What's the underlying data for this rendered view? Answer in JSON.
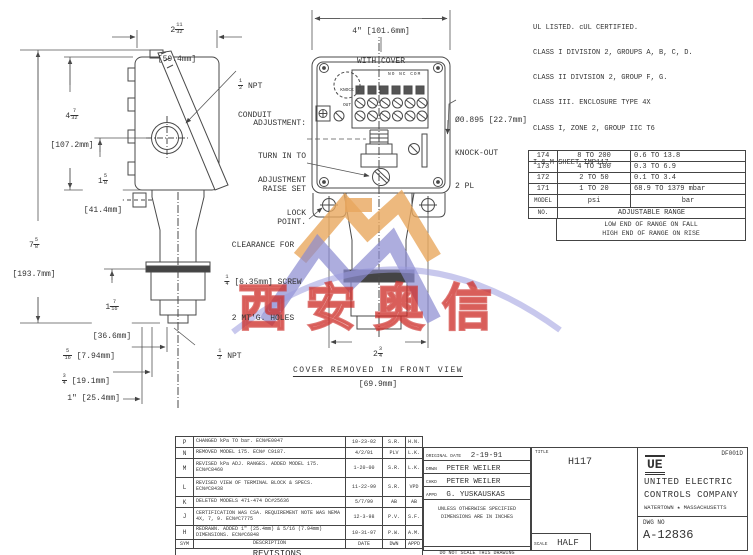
{
  "certifications": {
    "line1": "UL LISTED. cUL CERTIFIED.",
    "line2": "CLASS I DIVISION 2, GROUPS A, B, C, D.",
    "line3": "CLASS II DIVISION 2, GROUP F, G.",
    "line4": "CLASS III. ENCLOSURE TYPE 4X",
    "line5": "CLASS I, ZONE 2, GROUP IIC T6",
    "sheet": "I & M SHEET IMP117."
  },
  "range_table": {
    "rows": [
      {
        "model": "174",
        "psi": "8 TO 200",
        "bar": "0.6 TO 13.8"
      },
      {
        "model": "173",
        "psi": "4 TO 100",
        "bar": "0.3 TO 6.9"
      },
      {
        "model": "172",
        "psi": "2 TO 50",
        "bar": "0.1 TO 3.4"
      },
      {
        "model": "171",
        "psi": "1 TO 20",
        "bar": "68.9 TO 1379 mbar"
      }
    ],
    "model_label_1": "MODEL",
    "model_label_2": "NO.",
    "psi": "psi",
    "bar": "bar",
    "adjustable": "ADJUSTABLE RANGE",
    "note_fall": "LOW END OF RANGE ON FALL",
    "note_rise": "HIGH END OF RANGE ON RISE"
  },
  "dims": {
    "top_width": {
      "whole": "2",
      "num": "11",
      "den": "32",
      "metric": "[59.4mm]"
    },
    "body_height": {
      "whole": "4",
      "num": "7",
      "den": "32",
      "metric": "[107.2mm]"
    },
    "lower_height": {
      "whole": "1",
      "num": "5",
      "den": "8",
      "metric": "[41.4mm]"
    },
    "total_height": {
      "whole": "7",
      "num": "5",
      "den": "8",
      "metric": "[193.7mm]"
    },
    "port_height": {
      "whole": "1",
      "num": "7",
      "den": "16",
      "metric": "[36.6mm]"
    },
    "dim_516": {
      "num": "5",
      "den": "16",
      "metric": "[7.94mm]"
    },
    "dim_34": {
      "num": "3",
      "den": "4",
      "metric": "[19.1mm]"
    },
    "dim_1in": "1\" [25.4mm]",
    "cover_width_line1": "4\" [101.6mm]",
    "cover_width_line2": "WITH COVER",
    "front_width": {
      "whole": "2",
      "num": "3",
      "den": "4",
      "metric": "[69.9mm]"
    }
  },
  "callouts": {
    "npt_conduit": {
      "num": "1",
      "den": "2",
      "text1": "NPT",
      "text2": "CONDUIT"
    },
    "adj1": "ADJUSTMENT:",
    "adj2": "TURN IN TO",
    "adj3": "RAISE SET",
    "adj4": "POINT.",
    "lock1": "ADJUSTMENT",
    "lock2": "LOCK",
    "ko1": "Ø0.895 [22.7mm]",
    "ko2": "KNOCK-OUT",
    "ko3": "2 PL",
    "clr1": "CLEARANCE FOR",
    "clr_num": "1",
    "clr_den": "4",
    "clr2": "[6.35mm] SCREW",
    "clr3": "2 MT'G. HOLES",
    "npt_bottom": {
      "num": "1",
      "den": "2",
      "text": "NPT"
    },
    "cover_removed": "COVER REMOVED IN FRONT VIEW",
    "terminal_labels": "NO NC COM",
    "knock_circle_1": "KNOCK",
    "knock_circle_2": "OUT"
  },
  "revisions": {
    "title": "REVISIONS",
    "headers": {
      "sym": "SYM",
      "description": "DESCRIPTION",
      "date": "DATE",
      "dwn": "DWN",
      "appd": "APPD"
    },
    "rows": [
      {
        "sym": "P",
        "desc": "CHANGED kPa TO bar.  ECN#E0047",
        "date": "10-23-02",
        "dwn": "S.R.",
        "appd": "H.N."
      },
      {
        "sym": "N",
        "desc": "REMOVED MODEL 175. ECN# C9187.",
        "date": "4/2/01",
        "dwn": "PLV",
        "appd": "L.K."
      },
      {
        "sym": "M",
        "desc": "REVISED kPa ADJ. RANGES.  ADDED MODEL 175.  ECN#C8460",
        "date": "1-20-00",
        "dwn": "S.R.",
        "appd": "L.K."
      },
      {
        "sym": "L",
        "desc": "REVISED VIEW OF TERMINAL BLOCK & SPECS.  ECN#C8438",
        "date": "11-22-99",
        "dwn": "S.R.",
        "appd": "VPD"
      },
      {
        "sym": "K",
        "desc": "DELETED MODELS 471-474 DC#25636",
        "date": "5/7/99",
        "dwn": "AB",
        "appd": "AB"
      },
      {
        "sym": "J",
        "desc": "CERTIFICATION WAS CSA. REQUIREMENT NOTE WAS NEMA 4X, 7, 9.  ECN#C7775",
        "date": "12-3-98",
        "dwn": "P.V.",
        "appd": "S.F."
      },
      {
        "sym": "H",
        "desc": "REDRAWN. ADDED 1\" (25.4mm) & 5/16 (7.94mm) DIMENSIONS.  ECN#C6848",
        "date": "10-31-97",
        "dwn": "P.W.",
        "appd": "A.M."
      }
    ]
  },
  "info_block": {
    "original_date_label": "ORIGINAL DATE",
    "original_date": "2-19-91",
    "drwn_label": "DRWN",
    "drwn": "PETER WEILER",
    "chkd_label": "CHKD",
    "chkd": "PETER WEILER",
    "appd_label": "APPD",
    "appd": "G. YUSKAUSKAS",
    "spec_note_1": "UNLESS OTHERWISE SPECIFIED",
    "spec_note_2": "DIMENSIONS ARE IN INCHES",
    "no_scale": "DO NOT SCALE THIS DRAWING"
  },
  "title_block": {
    "title_label": "TITLE",
    "title": "H117",
    "form_no": "DF001D",
    "logo": "UE",
    "company_line1": "UNITED ELECTRIC",
    "company_line2": "CONTROLS COMPANY",
    "company_location": "WATERTOWN ★ MASSACHUSETTS",
    "dwg_no_label": "DWG NO",
    "dwg_no": "A-12836",
    "scale_label": "SCALE",
    "scale_value": "HALF"
  },
  "watermark": {
    "cjk_text": "西安奥信",
    "orange": "#e9a75e",
    "purple": "#8a8ad0",
    "red": "#d23732"
  }
}
